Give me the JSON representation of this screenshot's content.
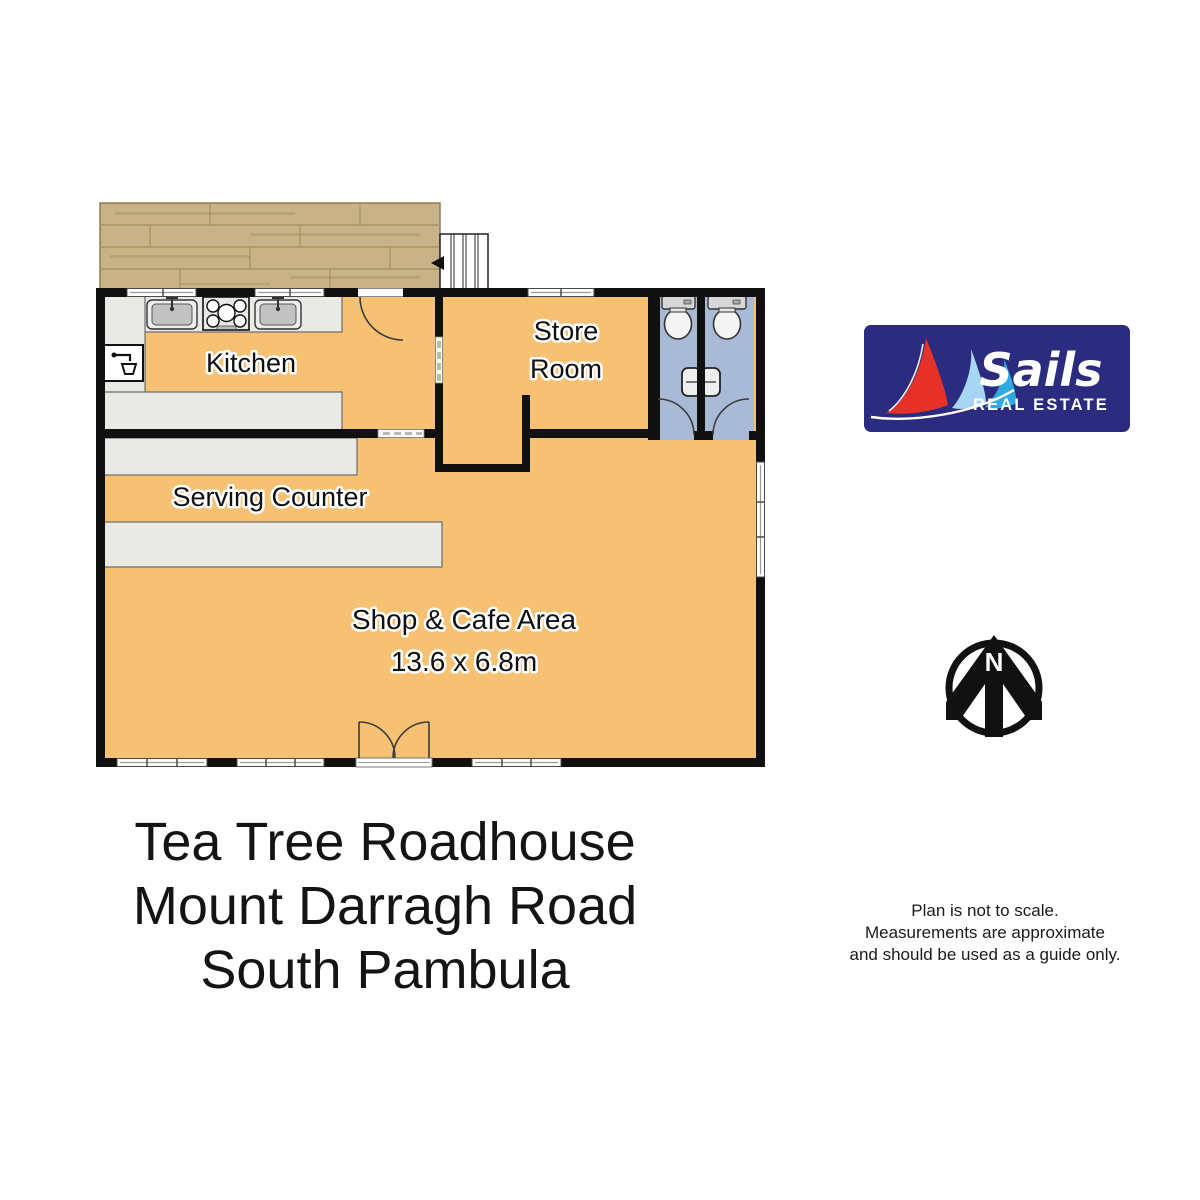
{
  "floor_plan": {
    "rooms": {
      "kitchen": {
        "label": "Kitchen"
      },
      "store_room": {
        "line1": "Store",
        "line2": "Room"
      },
      "serving_counter": {
        "label": "Serving Counter"
      },
      "shop_cafe": {
        "label": "Shop & Cafe Area",
        "dimensions": "13.6 x 6.8m"
      }
    },
    "colors": {
      "floor": "#f6c172",
      "wet_area": "#a9bad6",
      "deck_wood": "#c9b287",
      "counter": "#e9e9e6",
      "wall": "#101010"
    },
    "icons": {
      "stairs-icon": "staircase treads with down arrow",
      "sink-icon": "kitchen basin with tap",
      "stove-icon": "five burner cooktop",
      "tap-icon": "small wash tap unit",
      "toilet-icon": "toilet with cistern",
      "basin-icon": "small wall basin",
      "door-swing-icon": "quarter-circle door arc",
      "window-icon": "framed window strip"
    }
  },
  "compass": {
    "label": "N",
    "color": "#111111"
  },
  "logo": {
    "brand": "Sails",
    "tagline": "REAL ESTATE",
    "colors": {
      "background": "#2b2c80",
      "sail_red": "#e63128",
      "sail_light_blue": "#a7d6f4",
      "sail_blue": "#2fabe1",
      "text": "#ffffff"
    }
  },
  "address": {
    "line1": "Tea Tree Roadhouse",
    "line2": "Mount Darragh Road",
    "line3": "South Pambula"
  },
  "disclaimer": {
    "line1": "Plan is not to scale.",
    "line2": "Measurements are approximate",
    "line3": "and should be used as a guide only."
  }
}
